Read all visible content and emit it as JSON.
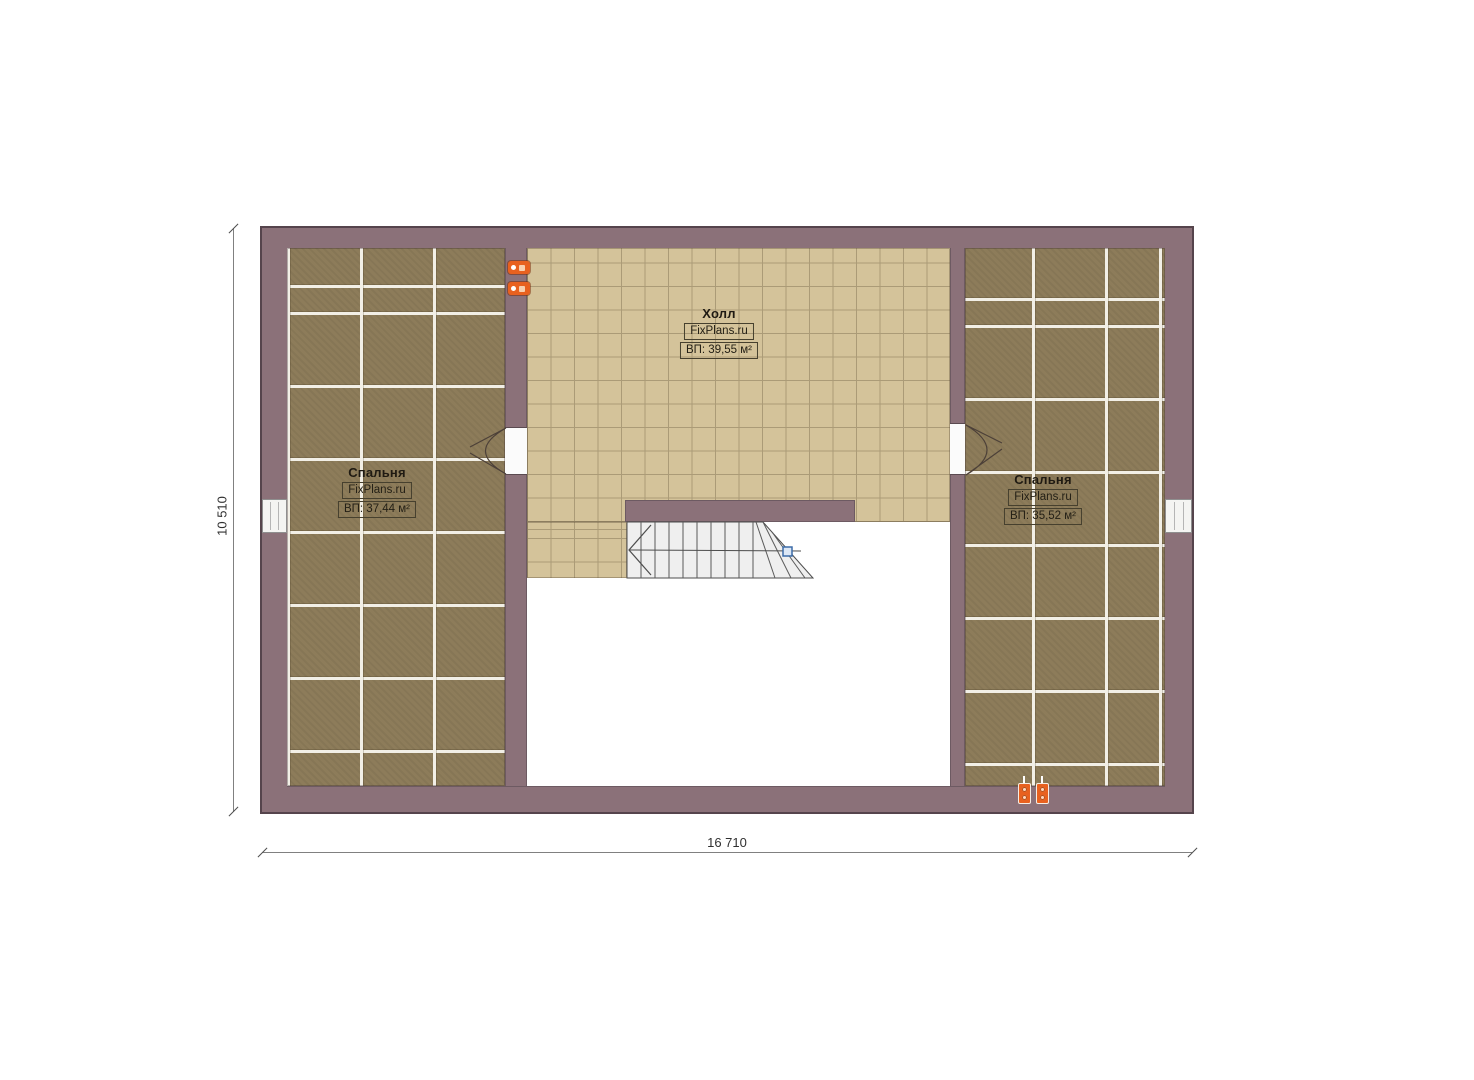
{
  "plan": {
    "rooms": {
      "bedroom_left": {
        "name": "Спальня",
        "brand": "FixPlans.ru",
        "area": "ВП: 37,44 м²"
      },
      "hall": {
        "name": "Холл",
        "brand": "FixPlans.ru",
        "area": "ВП: 39,55 м²"
      },
      "bedroom_right": {
        "name": "Спальня",
        "brand": "FixPlans.ru",
        "area": "ВП: 35,52 м²"
      }
    },
    "dimensions": {
      "width_label": "16 710",
      "height_label": "10 510"
    },
    "fixtures": {
      "stairs": "staircase",
      "doors": [
        "door-left-bedroom",
        "door-right-bedroom"
      ],
      "windows": [
        "window-left-wall",
        "window-right-wall"
      ],
      "sockets_top": "double-socket-pair",
      "sockets_bottom": "double-socket-pair"
    },
    "colors": {
      "wall": "#8b7179",
      "wall_edge": "#55444c",
      "carpet": "#8d7c5a",
      "carpet_grout": "#f2efe6",
      "tile": "#d4c39a",
      "tile_line": "#ab9b77",
      "stairs_fill": "#efefef",
      "accent_orange": "#e8611f",
      "accent_blue": "#3c6ca8",
      "dim_line": "#808080"
    }
  }
}
